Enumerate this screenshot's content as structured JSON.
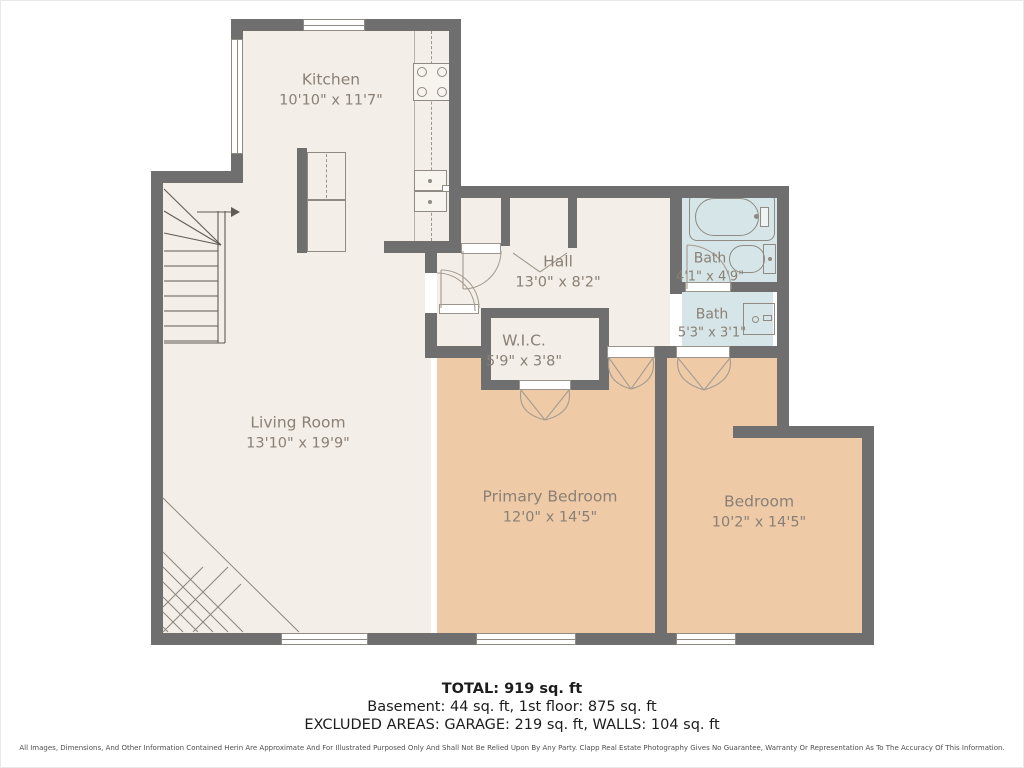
{
  "rooms": [
    {
      "name": "Kitchen",
      "dims": "10'10\" x 11'7\""
    },
    {
      "name": "Hall",
      "dims": "13'0\" x 8'2\""
    },
    {
      "name": "Bath",
      "dims": "4'1\" x 4'9\""
    },
    {
      "name": "Bath",
      "dims": "5'3\" x 3'1\""
    },
    {
      "name": "W.I.C.",
      "dims": "5'9\" x 3'8\""
    },
    {
      "name": "Living Room",
      "dims": "13'10\" x 19'9\""
    },
    {
      "name": "Primary Bedroom",
      "dims": "12'0\" x 14'5\""
    },
    {
      "name": "Bedroom",
      "dims": "10'2\" x 14'5\""
    }
  ],
  "summary": {
    "total": "TOTAL: 919 sq. ft",
    "line2": "Basement: 44 sq. ft, 1st floor: 875 sq. ft",
    "line3": "EXCLUDED AREAS: GARAGE: 219 sq. ft, WALLS: 104 sq. ft"
  },
  "disclaimer": "All Images, Dimensions, And Other Information Contained Herin Are Approximate And For Illustrated Purposed Only And Shall Not Be Relied Upon By Any Party. Clapp Real Estate Photography Gives No Guarantee, Warranty Or Representation As To The Accuracy Of This Information.",
  "colors": {
    "wall": "#6f6f6f",
    "floor": "#f3eee7",
    "bedroom_floor": "#eecaa7",
    "bath_floor": "#d6e5e7",
    "label_text": "#8a8076"
  }
}
